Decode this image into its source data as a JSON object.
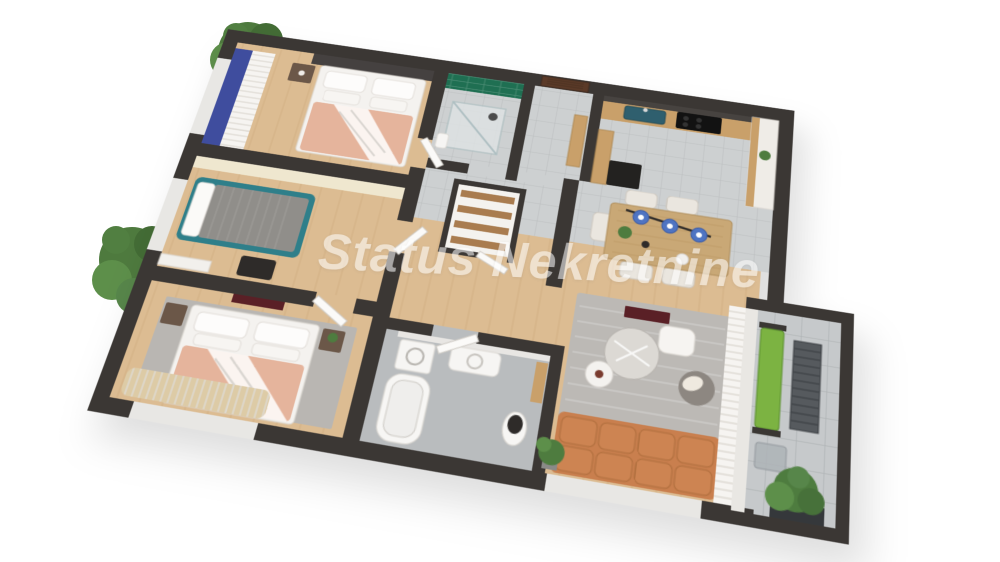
{
  "watermark": {
    "text": "Status Nekretnine",
    "color": "#ffffff",
    "opacity": 0.55
  },
  "palette": {
    "wall": "#3b3734",
    "wood_floor": "#dcbc92",
    "wood_line": "#c8a375",
    "tile_floor": "#cdd0d1",
    "tile_line": "#b9bcbe",
    "bath_tile": "#b9bcbe",
    "balcony_tile": "#c6c9cb",
    "green_tile": "#1f6f52",
    "peach": "#e5b49c",
    "teal": "#2f7f8a",
    "blue_wardrobe": "#3f4d9e",
    "pendant_blue": "#4f74c2",
    "sofa": "#c97f4e",
    "sofa_cushion": "#cd8452",
    "lime": "#7cb342",
    "door_brown": "#5b3a28",
    "counter_wood": "#c9a06a",
    "maroon": "#5a2026",
    "plant": "#4e7c3f",
    "white_furniture": "#f4f2ef"
  },
  "scene": {
    "type": "3d-floor-plan",
    "rooms": [
      {
        "id": "bedroom-1",
        "items": [
          "double-bed",
          "nightstand",
          "blue-wardrobe",
          "curtains"
        ]
      },
      {
        "id": "bedroom-2",
        "items": [
          "single-bed",
          "desk",
          "accent-wall"
        ]
      },
      {
        "id": "bedroom-3",
        "items": [
          "double-bed",
          "nightstands",
          "rug",
          "tv-panel",
          "curtains"
        ]
      },
      {
        "id": "shower-room",
        "items": [
          "glass-shower",
          "green-tile-wall"
        ]
      },
      {
        "id": "entry-hall",
        "items": [
          "entrance-door",
          "shoe-cabinet"
        ]
      },
      {
        "id": "storage-closet",
        "items": [
          "wooden-shelves"
        ]
      },
      {
        "id": "kitchen",
        "items": [
          "counter",
          "sink",
          "cooktop",
          "tall-cabinet",
          "plant"
        ]
      },
      {
        "id": "dining-area",
        "items": [
          "dining-table",
          "chairs",
          "pendant-lamps",
          "plant"
        ]
      },
      {
        "id": "living-room",
        "items": [
          "sofa",
          "rug",
          "coffee-tables",
          "pouf",
          "accent-chair",
          "curtains",
          "plant"
        ]
      },
      {
        "id": "bathroom",
        "items": [
          "bathtub",
          "toilet",
          "washing-machine",
          "vanity"
        ]
      },
      {
        "id": "balcony",
        "items": [
          "bench",
          "slat-table",
          "side-table",
          "shrub-planter"
        ]
      }
    ],
    "exterior": [
      "tree",
      "tree"
    ]
  }
}
